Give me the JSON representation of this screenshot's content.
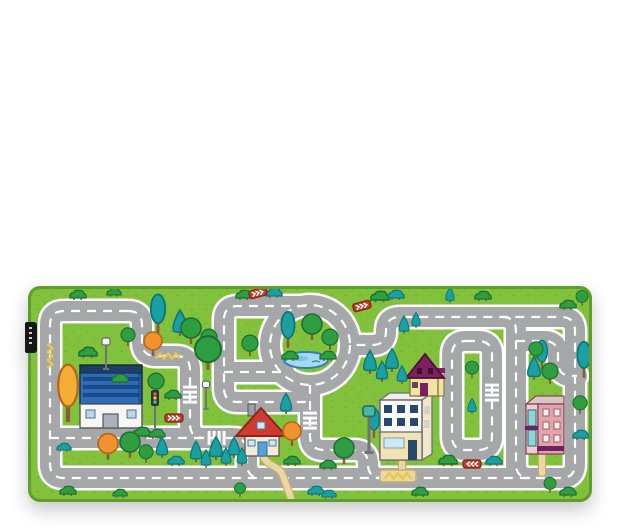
{
  "product_photo": {
    "subject": "children road play rug on white background",
    "brand_tag_text": ""
  },
  "colors": {
    "background": "#ffffff",
    "grass": "#82c13c",
    "grassDot": "#6da633",
    "matEdge": "#5d9e2c",
    "road": "#a5a7a9",
    "roadLine": "#ffffff",
    "pond": "#a6d9f2",
    "pondEdge": "#2f7fb4",
    "pondDeep": "#7cc3e8",
    "treeGreen": "#2f9e43",
    "treeGreenDark": "#1c6f2f",
    "treeTeal": "#1aa0a2",
    "treeTealDark": "#0d7678",
    "treeOrange": "#f0932f",
    "treeOrangeDark": "#b5661a",
    "treeYellow": "#f3ae33",
    "trunk": "#8a5a35",
    "signRed": "#c5392b",
    "path": "#e9d7a4",
    "pathEdge": "#c9ae6b",
    "zigzag": "#e8c94f",
    "tag": "#171717",
    "bldgBlueDark": "#1d3f66",
    "bldgBlue": "#2e6cb8",
    "bldgBlueWin": "#1b4a86",
    "roofRed": "#cf3b30",
    "roofRedDark": "#8e241c",
    "doorBlue": "#56a2d8",
    "officeSide": "#efe6cc",
    "officeWin": "#27496e",
    "officeGround": "#f3e2b4",
    "officeGlass": "#cfe9f4",
    "plum": "#7c2060",
    "plumDark": "#4c1038",
    "houseYellow": "#f2e3a1",
    "pinkFront": "#e2a3ad",
    "pinkSide": "#f2cad1",
    "pinkWin": "#fbecee",
    "pinkWinFrame": "#95606b",
    "tealGlass": "#8fd4d8",
    "awning": "#6e2160",
    "lampGray": "#6f7377"
  },
  "scene": {
    "trees": [
      {
        "t": "oval",
        "x": 130,
        "y": 48,
        "s": 1.2
      },
      {
        "t": "conifer",
        "x": 152,
        "y": 50,
        "s": 1
      },
      {
        "t": "orange",
        "x": 125,
        "y": 70,
        "s": 1
      },
      {
        "t": "round",
        "x": 163,
        "y": 58,
        "s": 1
      },
      {
        "t": "round",
        "x": 181,
        "y": 64,
        "s": 0.8
      },
      {
        "t": "round",
        "x": 180,
        "y": 84,
        "s": 1.3
      },
      {
        "t": "bush",
        "x": 216,
        "y": 12,
        "s": 0.8
      },
      {
        "t": "tealbush",
        "x": 246,
        "y": 10,
        "s": 0.8
      },
      {
        "t": "bush",
        "x": 352,
        "y": 14,
        "s": 0.9
      },
      {
        "t": "tealbush",
        "x": 368,
        "y": 12,
        "s": 0.8
      },
      {
        "t": "bush",
        "x": 50,
        "y": 12,
        "s": 0.8
      },
      {
        "t": "bush",
        "x": 86,
        "y": 9,
        "s": 0.7
      },
      {
        "t": "bush",
        "x": 60,
        "y": 70,
        "s": 0.9
      },
      {
        "t": "bush",
        "x": 92,
        "y": 96,
        "s": 0.8
      },
      {
        "t": "round",
        "x": 100,
        "y": 60,
        "s": 0.7
      },
      {
        "t": "yellow",
        "x": 40,
        "y": 136,
        "s": 1.4
      },
      {
        "t": "bush",
        "x": 114,
        "y": 150,
        "s": 0.9
      },
      {
        "t": "bush",
        "x": 129,
        "y": 151,
        "s": 0.8
      },
      {
        "t": "round",
        "x": 128,
        "y": 108,
        "s": 0.8
      },
      {
        "t": "bush",
        "x": 145,
        "y": 112,
        "s": 0.8
      },
      {
        "t": "oval",
        "x": 260,
        "y": 62,
        "s": 1.1
      },
      {
        "t": "round",
        "x": 284,
        "y": 54,
        "s": 1
      },
      {
        "t": "round",
        "x": 302,
        "y": 64,
        "s": 0.8
      },
      {
        "t": "bush",
        "x": 262,
        "y": 73,
        "s": 0.8
      },
      {
        "t": "bush",
        "x": 300,
        "y": 73,
        "s": 0.8
      },
      {
        "t": "round",
        "x": 222,
        "y": 70,
        "s": 0.8
      },
      {
        "t": "conifer",
        "x": 376,
        "y": 48,
        "s": 0.7
      },
      {
        "t": "conifer",
        "x": 388,
        "y": 42,
        "s": 0.6
      },
      {
        "t": "conifer",
        "x": 342,
        "y": 88,
        "s": 0.9
      },
      {
        "t": "conifer",
        "x": 354,
        "y": 96,
        "s": 0.8
      },
      {
        "t": "conifer",
        "x": 364,
        "y": 86,
        "s": 0.9
      },
      {
        "t": "conifer",
        "x": 374,
        "y": 98,
        "s": 0.7
      },
      {
        "t": "round",
        "x": 444,
        "y": 92,
        "s": 0.65
      },
      {
        "t": "conifer",
        "x": 444,
        "y": 128,
        "s": 0.6
      },
      {
        "t": "conifer",
        "x": 506,
        "y": 94,
        "s": 0.9
      },
      {
        "t": "oval",
        "x": 514,
        "y": 84,
        "s": 0.9
      },
      {
        "t": "round",
        "x": 522,
        "y": 98,
        "s": 0.8
      },
      {
        "t": "round",
        "x": 508,
        "y": 74,
        "s": 0.7
      },
      {
        "t": "oval",
        "x": 556,
        "y": 92,
        "s": 1.1
      },
      {
        "t": "round",
        "x": 552,
        "y": 128,
        "s": 0.7
      },
      {
        "t": "tealbush",
        "x": 553,
        "y": 152,
        "s": 0.8
      },
      {
        "t": "bush",
        "x": 540,
        "y": 22,
        "s": 0.8
      },
      {
        "t": "round",
        "x": 554,
        "y": 20,
        "s": 0.6
      },
      {
        "t": "conifer",
        "x": 422,
        "y": 17,
        "s": 0.6
      },
      {
        "t": "bush",
        "x": 455,
        "y": 13,
        "s": 0.8
      },
      {
        "t": "orange",
        "x": 80,
        "y": 174,
        "s": 1.1
      },
      {
        "t": "round",
        "x": 102,
        "y": 172,
        "s": 1
      },
      {
        "t": "round",
        "x": 118,
        "y": 177,
        "s": 0.7
      },
      {
        "t": "conifer",
        "x": 134,
        "y": 172,
        "s": 0.8
      },
      {
        "t": "tealbush",
        "x": 148,
        "y": 178,
        "s": 0.8
      },
      {
        "t": "conifer",
        "x": 168,
        "y": 176,
        "s": 0.8
      },
      {
        "t": "conifer",
        "x": 178,
        "y": 182,
        "s": 0.7
      },
      {
        "t": "conifer",
        "x": 188,
        "y": 174,
        "s": 0.9
      },
      {
        "t": "conifer",
        "x": 198,
        "y": 180,
        "s": 0.7
      },
      {
        "t": "conifer",
        "x": 206,
        "y": 172,
        "s": 0.8
      },
      {
        "t": "conifer",
        "x": 214,
        "y": 180,
        "s": 0.7
      },
      {
        "t": "conifer",
        "x": 258,
        "y": 128,
        "s": 0.8
      },
      {
        "t": "orange",
        "x": 264,
        "y": 160,
        "s": 1
      },
      {
        "t": "bush",
        "x": 264,
        "y": 178,
        "s": 0.8
      },
      {
        "t": "round",
        "x": 316,
        "y": 178,
        "s": 1
      },
      {
        "t": "bush",
        "x": 300,
        "y": 182,
        "s": 0.8
      },
      {
        "t": "oval",
        "x": 346,
        "y": 152,
        "s": 0.9
      },
      {
        "t": "bush",
        "x": 40,
        "y": 208,
        "s": 0.8
      },
      {
        "t": "bush",
        "x": 92,
        "y": 210,
        "s": 0.7
      },
      {
        "t": "round",
        "x": 212,
        "y": 211,
        "s": 0.55
      },
      {
        "t": "tealbush",
        "x": 288,
        "y": 208,
        "s": 0.8
      },
      {
        "t": "tealbush",
        "x": 301,
        "y": 211,
        "s": 0.7
      },
      {
        "t": "bush",
        "x": 392,
        "y": 209,
        "s": 0.8
      },
      {
        "t": "round",
        "x": 522,
        "y": 207,
        "s": 0.6
      },
      {
        "t": "bush",
        "x": 540,
        "y": 209,
        "s": 0.8
      },
      {
        "t": "bush",
        "x": 420,
        "y": 178,
        "s": 0.9
      },
      {
        "t": "tealbush",
        "x": 466,
        "y": 178,
        "s": 0.8
      },
      {
        "t": "tealbush",
        "x": 36,
        "y": 164,
        "s": 0.7
      }
    ],
    "signs": [
      {
        "x": 230,
        "y": 7,
        "r": -15
      },
      {
        "x": 334,
        "y": 20,
        "r": -15
      },
      {
        "x": 146,
        "y": 132,
        "r": 0
      },
      {
        "x": 444,
        "y": 178,
        "r": 180
      }
    ],
    "lamps": [
      {
        "x": 78,
        "y": 84,
        "s": 1
      },
      {
        "x": 178,
        "y": 124,
        "s": 0.9
      },
      {
        "x": 341,
        "y": 168,
        "s": 1.5,
        "v": "teal"
      }
    ],
    "traffic_lights": [
      {
        "x": 127,
        "y": 142,
        "s": 1
      }
    ],
    "crosswalks": [
      {
        "x": 188,
        "y": 152,
        "r": 0
      },
      {
        "x": 162,
        "y": 108,
        "r": 90
      },
      {
        "x": 464,
        "y": 106,
        "r": 90
      },
      {
        "x": 282,
        "y": 134,
        "r": 90
      }
    ],
    "zigzags": [
      {
        "x": 22,
        "y": 70,
        "r": 90,
        "s": 1
      },
      {
        "x": 140,
        "y": 70,
        "r": 0,
        "s": 1
      },
      {
        "x": 370,
        "y": 190,
        "r": 0,
        "s": 1.1
      }
    ]
  }
}
